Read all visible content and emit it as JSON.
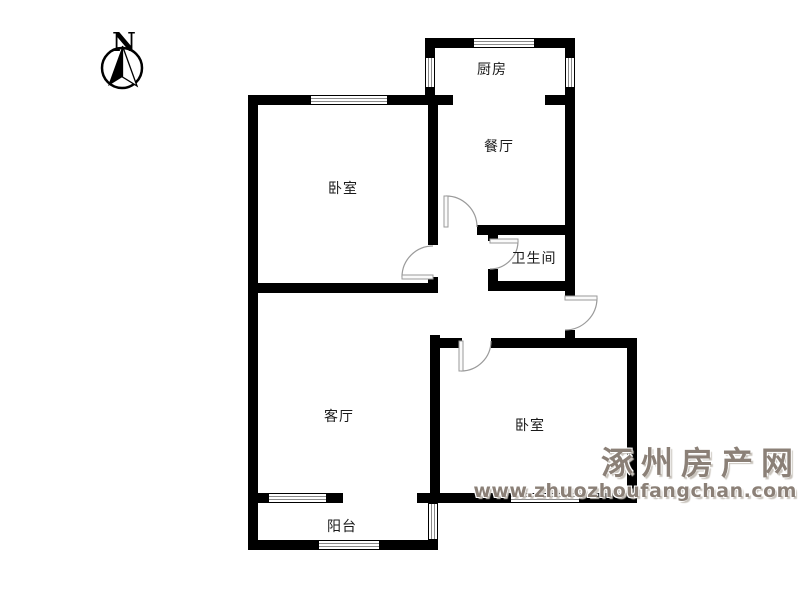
{
  "compass": {
    "label": "N"
  },
  "rooms": [
    {
      "name": "kitchen",
      "label": "厨房",
      "x": 492,
      "y": 69
    },
    {
      "name": "dining-room",
      "label": "餐厅",
      "x": 499,
      "y": 146
    },
    {
      "name": "bedroom-1",
      "label": "卧室",
      "x": 343,
      "y": 188
    },
    {
      "name": "bathroom",
      "label": "卫生间",
      "x": 534,
      "y": 258
    },
    {
      "name": "living-room",
      "label": "客厅",
      "x": 339,
      "y": 416
    },
    {
      "name": "bedroom-2",
      "label": "卧室",
      "x": 530,
      "y": 425
    },
    {
      "name": "balcony",
      "label": "阳台",
      "x": 342,
      "y": 526
    }
  ],
  "watermark": {
    "title": "涿州房产网",
    "url": "www.zhuozhoufangchan.com",
    "color": "#8b8077"
  },
  "floorplan": {
    "wall_color": "#000000",
    "window_stripe_color": "#8a8a8a",
    "door_color": "#9a9a9a",
    "walls": [
      [
        425,
        38,
        150,
        10
      ],
      [
        248,
        95,
        205,
        10
      ],
      [
        545,
        95,
        30,
        10
      ],
      [
        477,
        225,
        98,
        10
      ],
      [
        248,
        283,
        190,
        10
      ],
      [
        488,
        281,
        87,
        10
      ],
      [
        430,
        338,
        32,
        10
      ],
      [
        491,
        338,
        141,
        10
      ],
      [
        248,
        493,
        95,
        10
      ],
      [
        417,
        493,
        220,
        10
      ],
      [
        248,
        540,
        190,
        10
      ],
      [
        248,
        95,
        10,
        455
      ],
      [
        425,
        38,
        10,
        67
      ],
      [
        565,
        38,
        10,
        260
      ],
      [
        565,
        330,
        10,
        18
      ],
      [
        428,
        95,
        10,
        150
      ],
      [
        428,
        277,
        10,
        16
      ],
      [
        488,
        225,
        10,
        16
      ],
      [
        488,
        269,
        10,
        20
      ],
      [
        430,
        335,
        10,
        168
      ],
      [
        627,
        338,
        10,
        165
      ]
    ],
    "windows": [
      {
        "x": 473,
        "y": 38,
        "w": 62,
        "h": 10,
        "o": "h"
      },
      {
        "x": 310,
        "y": 95,
        "w": 78,
        "h": 10,
        "o": "h"
      },
      {
        "x": 268,
        "y": 493,
        "w": 59,
        "h": 10,
        "o": "h"
      },
      {
        "x": 510,
        "y": 493,
        "w": 70,
        "h": 10,
        "o": "h"
      },
      {
        "x": 318,
        "y": 540,
        "w": 62,
        "h": 10,
        "o": "h"
      },
      {
        "x": 425,
        "y": 57,
        "w": 10,
        "h": 31,
        "o": "v"
      },
      {
        "x": 565,
        "y": 57,
        "w": 10,
        "h": 31,
        "o": "v"
      },
      {
        "x": 428,
        "y": 503,
        "w": 10,
        "h": 37,
        "o": "v"
      }
    ],
    "doors": [
      {
        "name": "dining-door",
        "leaf": [
          446,
          196,
          446,
          227
        ],
        "arc": "M446,196 A31,31 0 0 1 477,227"
      },
      {
        "name": "bedroom-1-door",
        "leaf": [
          402,
          277,
          433,
          277
        ],
        "arc": "M402,277 A31,31 0 0 1 433,246"
      },
      {
        "name": "bathroom-door",
        "leaf": [
          490,
          241,
          518,
          241
        ],
        "arc": "M518,241 A28,28 0 0 1 490,269"
      },
      {
        "name": "entrance-door",
        "leaf": [
          565,
          298,
          597,
          298
        ],
        "arc": "M597,298 A32,32 0 0 1 565,330"
      },
      {
        "name": "bedroom-2-door",
        "leaf": [
          461,
          341,
          461,
          371
        ],
        "arc": "M461,371 A30,30 0 0 0 491,341"
      }
    ]
  }
}
